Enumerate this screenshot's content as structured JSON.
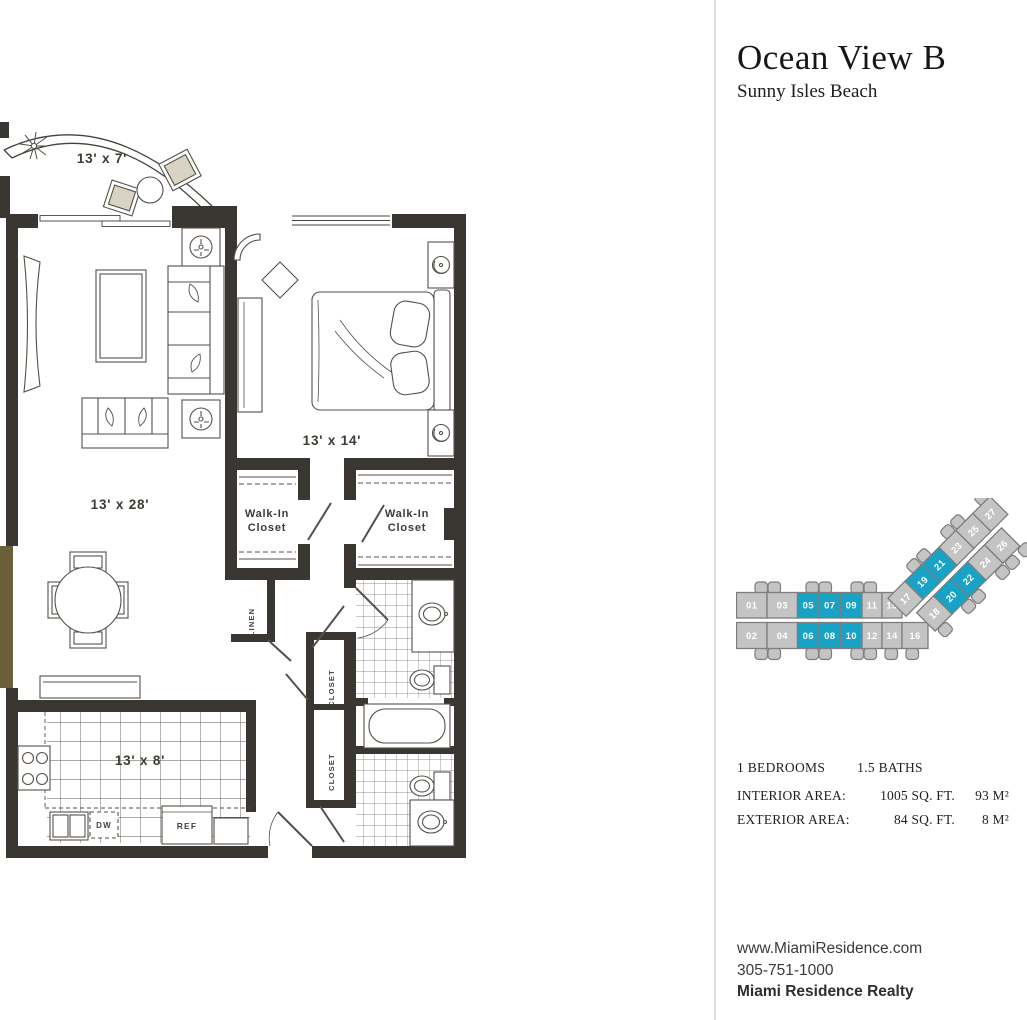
{
  "header": {
    "title": "Ocean View B",
    "subtitle": "Sunny Isles Beach"
  },
  "floorplan": {
    "rooms": {
      "balcony": "13' x 7'",
      "living": "13' x 28'",
      "bedroom": "13' x 14'",
      "kitchen": "13' x 8'",
      "walkin_line1": "Walk-In",
      "walkin_line2": "Closet",
      "linen": "LINEN",
      "closet": "CLOSET",
      "dw": "DW",
      "ref": "REF"
    }
  },
  "keyplan": {
    "row_top": [
      "01",
      "03",
      "05",
      "07",
      "09",
      "11",
      "15"
    ],
    "row_bottom": [
      "02",
      "04",
      "06",
      "08",
      "10",
      "12",
      "14",
      "16"
    ],
    "row_angled_top": [
      "17",
      "19",
      "21",
      "23",
      "25",
      "27"
    ],
    "row_angled_bottom": [
      "18",
      "20",
      "22",
      "24",
      "26"
    ],
    "highlighted_units": [
      "05",
      "07",
      "09",
      "06",
      "08",
      "10",
      "19",
      "21",
      "20",
      "22"
    ],
    "unit_fill": "#c5c4c4",
    "unit_border": "#7d7d7d",
    "highlight_fill": "#17a2c6",
    "label_color": "#ffffff"
  },
  "details": {
    "bedrooms": "1 BEDROOMS",
    "baths": "1.5 BATHS",
    "interior_label": "INTERIOR AREA:",
    "interior_sqft": "1005 SQ. FT.",
    "interior_m2": "93 M²",
    "exterior_label": "EXTERIOR AREA:",
    "exterior_sqft": "84 SQ. FT.",
    "exterior_m2": "8 M²"
  },
  "footer": {
    "website": "www.MiamiResidence.com",
    "phone": "305-751-1000",
    "company": "Miami Residence Realty"
  }
}
